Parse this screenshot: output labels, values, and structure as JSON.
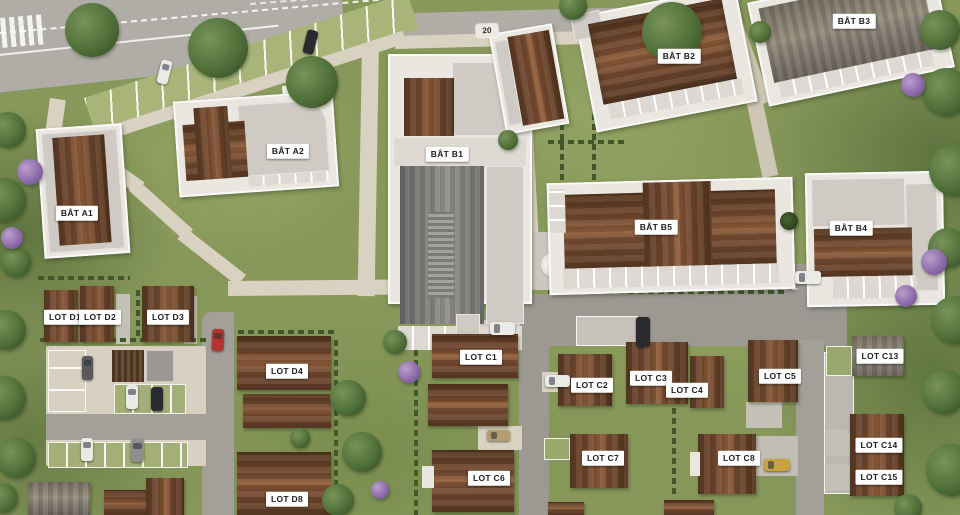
{
  "scene": {
    "description": "Aerial 3D masterplan rendering of a residential development with collective buildings (BAT) and individual house lots (LOT), roads, parking areas and gardens",
    "speed_limit_marking": "20"
  },
  "palette": {
    "grass": "#87985A",
    "asphalt": "#9D9A94",
    "path": "#D9D1C1",
    "parking_green": "#A9B479",
    "roof_brown": "#7B4F33",
    "roof_gray": "#8C8B88",
    "flat_roof": "#CFCBC4",
    "label_background": "#FFFFFF",
    "label_text": "#1C1C1C"
  },
  "map_labels": [
    {
      "id": "bat-a1",
      "text": "BÂT A1"
    },
    {
      "id": "bat-a2",
      "text": "BÂT A2"
    },
    {
      "id": "bat-b1",
      "text": "BÂT B1"
    },
    {
      "id": "bat-b2",
      "text": "BÂT B2"
    },
    {
      "id": "bat-b3",
      "text": "BÂT B3"
    },
    {
      "id": "bat-b5",
      "text": "BÂT B5"
    },
    {
      "id": "bat-b4",
      "text": "BÂT B4"
    },
    {
      "id": "lot-d1",
      "text": "LOT D1"
    },
    {
      "id": "lot-d2",
      "text": "LOT D2"
    },
    {
      "id": "lot-d3",
      "text": "LOT D3"
    },
    {
      "id": "lot-d4",
      "text": "LOT D4"
    },
    {
      "id": "lot-d8",
      "text": "LOT D8"
    },
    {
      "id": "lot-c1",
      "text": "LOT C1"
    },
    {
      "id": "lot-c2",
      "text": "LOT C2"
    },
    {
      "id": "lot-c3",
      "text": "LOT C3"
    },
    {
      "id": "lot-c4",
      "text": "LOT C4"
    },
    {
      "id": "lot-c5",
      "text": "LOT C5"
    },
    {
      "id": "lot-c13",
      "text": "LOT C13"
    },
    {
      "id": "lot-c6",
      "text": "LOT C6"
    },
    {
      "id": "lot-c7",
      "text": "LOT C7"
    },
    {
      "id": "lot-c8",
      "text": "LOT C8"
    },
    {
      "id": "lot-c14",
      "text": "LOT C14"
    },
    {
      "id": "lot-c15",
      "text": "LOT C15"
    }
  ]
}
